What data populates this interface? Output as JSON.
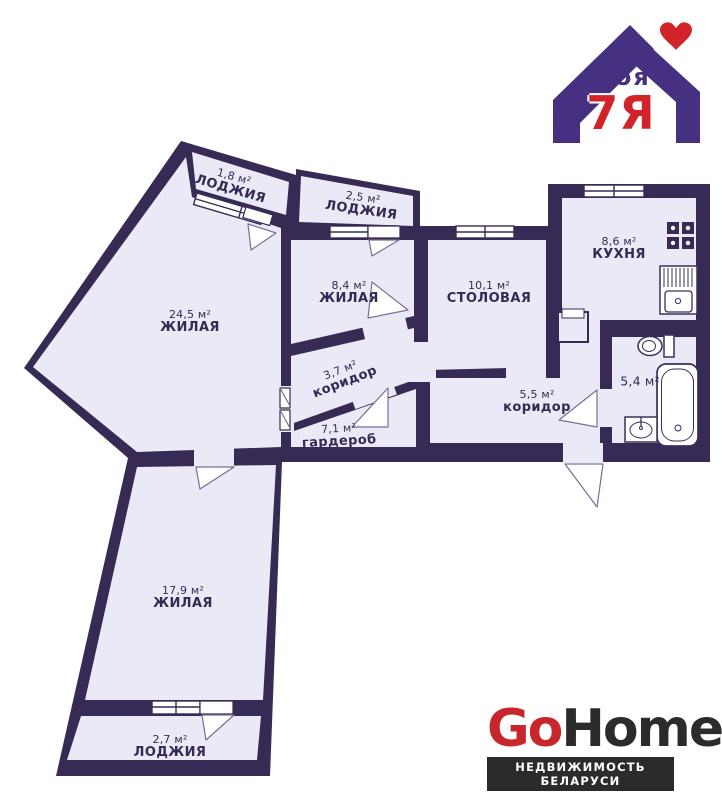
{
  "colors": {
    "wall": "#372b55",
    "room_fill": "#ebe9f6",
    "logo_purple": "#453081",
    "logo_red": "#d2232a",
    "gohome_red": "#c9252c",
    "gohome_dark": "#2d2b2a"
  },
  "header_logo": {
    "moya": "моя",
    "seven_ya": "7Я"
  },
  "footer_logo": {
    "go": "Go",
    "home": "Home",
    "tagline": "НЕДВИЖИМОСТЬ БЕЛАРУСИ"
  },
  "floor_plan": {
    "rooms": [
      {
        "id": "loggia-top-left",
        "name": "ЛОДЖИЯ",
        "area": "1,8 м²"
      },
      {
        "id": "loggia-top",
        "name": "ЛОДЖИЯ",
        "area": "2,5 м²"
      },
      {
        "id": "living-large",
        "name": "ЖИЛАЯ",
        "area": "24,5 м²"
      },
      {
        "id": "living-middle",
        "name": "ЖИЛАЯ",
        "area": "8,4 м²"
      },
      {
        "id": "dining",
        "name": "СТОЛОВАЯ",
        "area": "10,1 м²"
      },
      {
        "id": "kitchen",
        "name": "КУХНЯ",
        "area": "8,6 м²"
      },
      {
        "id": "corridor-inner",
        "name": "коридор",
        "area": "3,7 м²"
      },
      {
        "id": "wardrobe",
        "name": "гардероб",
        "area": "7,1 м²"
      },
      {
        "id": "corridor-entry",
        "name": "коридор",
        "area": "5,5 м²"
      },
      {
        "id": "bathroom",
        "name": "",
        "area": "5,4 м²"
      },
      {
        "id": "living-bottom",
        "name": "ЖИЛАЯ",
        "area": "17,9 м²"
      },
      {
        "id": "loggia-bottom",
        "name": "ЛОДЖИЯ",
        "area": "2,7 м²"
      }
    ]
  }
}
